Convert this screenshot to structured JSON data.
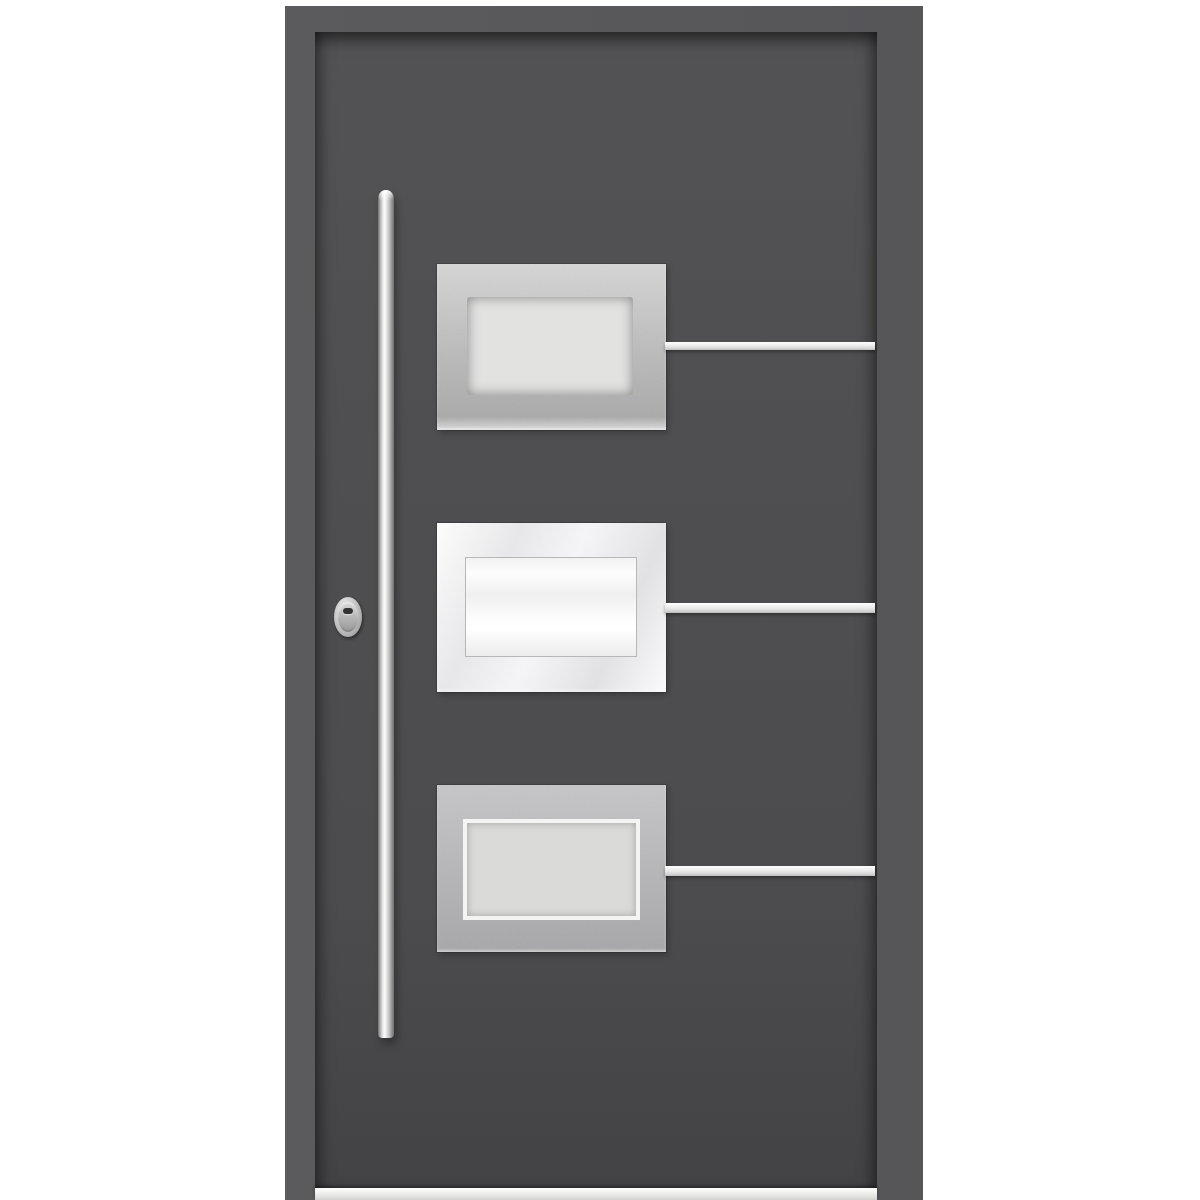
{
  "image": {
    "type": "product-photo",
    "subject": "Modern aluminium front entry door",
    "description": "Anthracite grey aluminium entry door shown on a white background: long vertical stainless-steel bar pull handle on the left, oval security lock cylinder, three rectangular brushed stainless-steel glazing panels with frosted glass stacked vertically, a horizontal stainless inlay strip extending to the right from the middle of each panel, and an aluminium threshold sill at the bottom."
  },
  "elements": {
    "door_frame": "door frame",
    "door_leaf": "door leaf",
    "handle": "vertical bar pull handle",
    "lock": "oval lock cylinder with keyhole",
    "panels": [
      {
        "label": "top glazing panel",
        "finish": "brushed stainless steel",
        "glass": "frosted grey"
      },
      {
        "label": "middle glazing panel",
        "finish": "polished bright steel",
        "glass": "bright frosted white"
      },
      {
        "label": "bottom glazing panel",
        "finish": "brushed stainless steel",
        "glass": "frosted grey with white bevel border"
      }
    ],
    "strips": [
      {
        "label": "top inlay strip"
      },
      {
        "label": "middle inlay strip"
      },
      {
        "label": "bottom inlay strip"
      }
    ],
    "threshold": "aluminium threshold sill"
  },
  "colors": {
    "bg": "#ffffff",
    "frame": "#5b5b5d",
    "frame-dark": "#565659",
    "leaf": "#4e4e50",
    "steel": "#bfbfbf",
    "steel-bright": "#f7f7f9",
    "steel-dark": "#b3b3b5",
    "glass": "#e2e2e0",
    "glass-bright": "#ffffff",
    "strip": "#ececec",
    "handle-hi": "#fbfbfb",
    "lock": "#8f8f8f",
    "keyhole": "#333335",
    "threshold": "#e9e9e7"
  }
}
